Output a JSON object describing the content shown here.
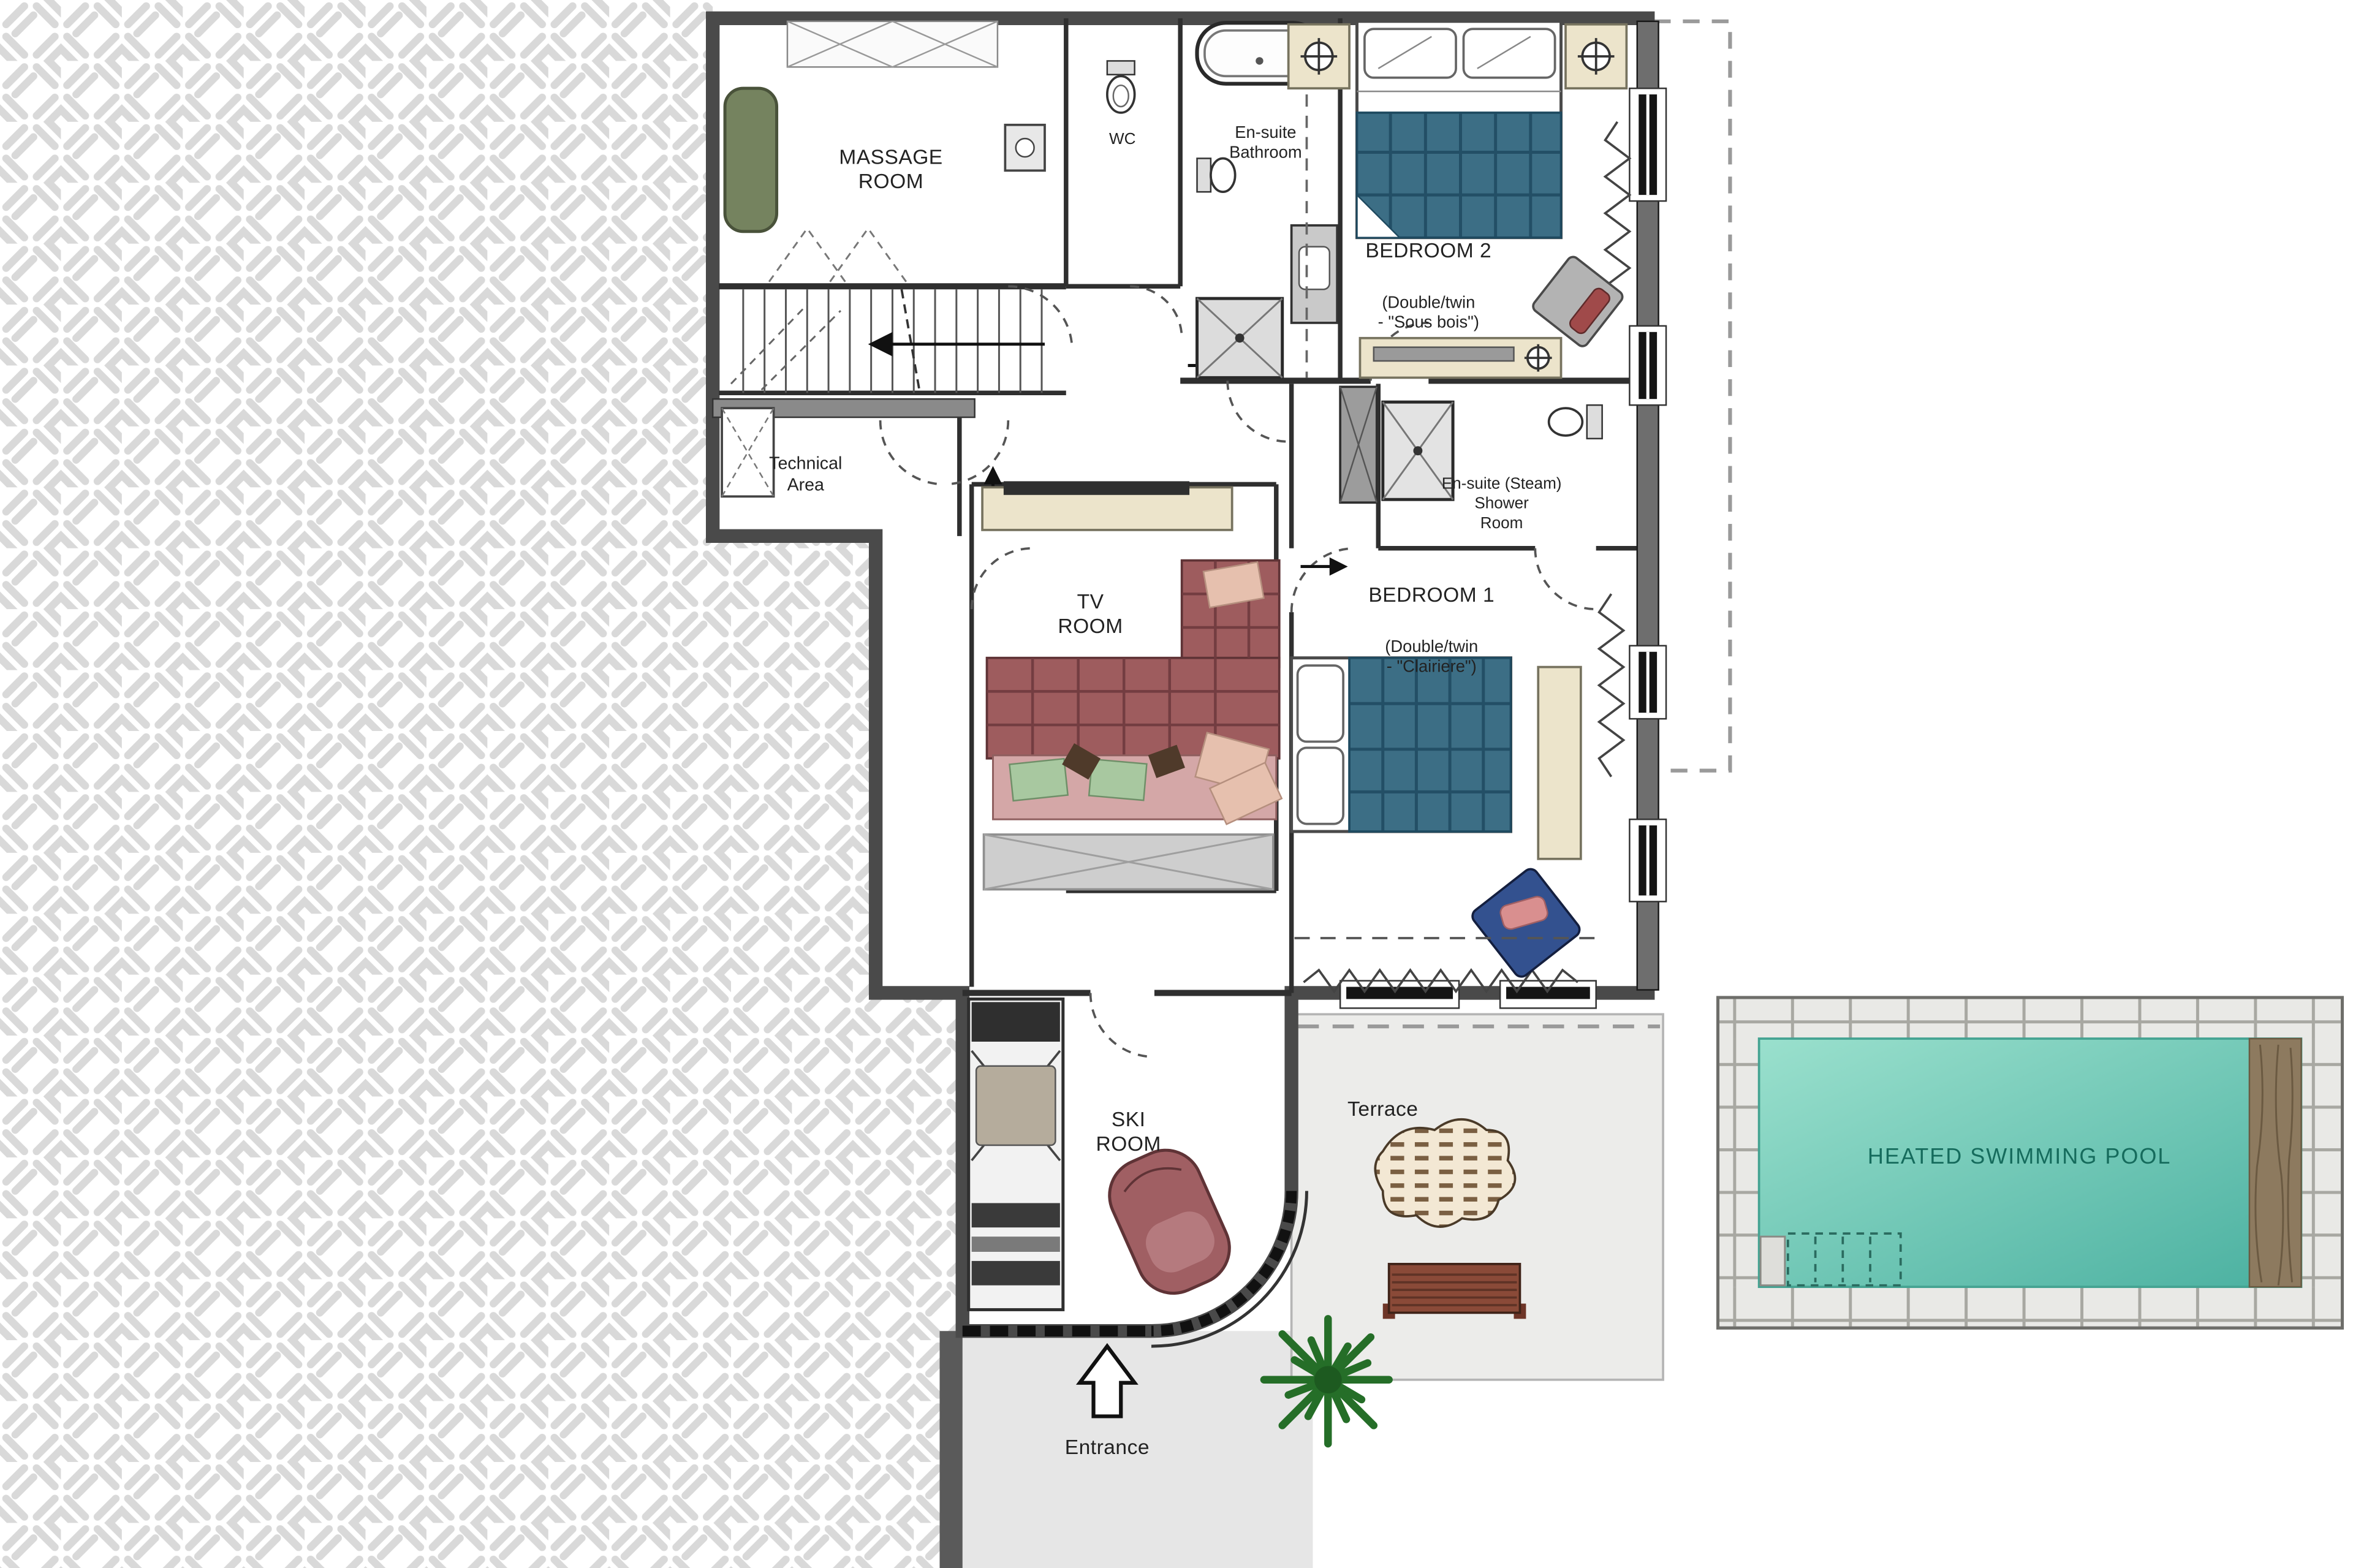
{
  "labels": {
    "massage_room": "MASSAGE\nROOM",
    "wc": "WC",
    "ensuite_bathroom": "En-suite\nBathroom",
    "bedroom2_title": "BEDROOM 2",
    "bedroom2_sub": "(Double/twin\n- \"Sous bois\")",
    "technical_area": "Technical\nArea",
    "tv_room": "TV\nROOM",
    "steam_shower": "En-suite (Steam)\nShower\nRoom",
    "bedroom1_title": "BEDROOM 1",
    "bedroom1_sub": "(Double/twin\n- \"Clairiere\")",
    "ski_room": "SKI\nROOM",
    "terrace": "Terrace",
    "entrance": "Entrance",
    "pool": "HEATED SWIMMING POOL"
  },
  "palette": {
    "wall": "#4a4a4a",
    "paving_line": "#d9d9d9",
    "terrace_fill": "#ececea",
    "walkway_fill": "#e6e6e6",
    "pool_water_light": "#9ae0cd",
    "pool_water_dark": "#4ab0a0",
    "pool_stone": "#e9e9e6",
    "pool_deck_wood": "#8d7a5f",
    "pool_text": "#156b5c",
    "bed_blanket_blue": "#3c6e85",
    "sofa_red": "#9e5c5e",
    "armchair_blue": "#33518f",
    "massage_table_green": "#75835f",
    "furniture_cream": "#ece4cb",
    "tree_green": "#256e28",
    "terrace_bench_brown": "#8a4a38",
    "ski_bench_red": "#a05f63"
  }
}
